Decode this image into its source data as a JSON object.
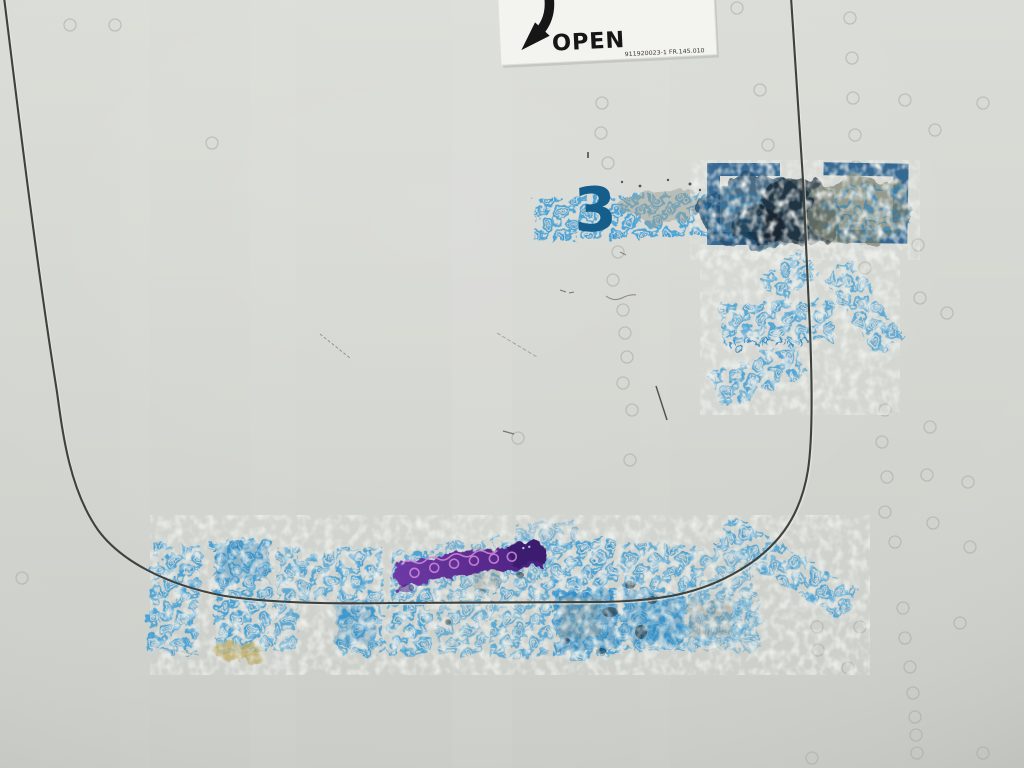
{
  "placard": {
    "label": "OPEN",
    "part_number": "911920023-1   FR.145.010",
    "arrow_icon": "arrow-down-left"
  },
  "panel": {
    "stencil_number": "3"
  },
  "stamps": {
    "micro_text": "101"
  },
  "colors": {
    "background_top": "#dadcd7",
    "background_bottom": "#cbcec8",
    "seam": "#3f413c",
    "seam_highlight": "#eceee9",
    "stencil_blue": "#155d8b",
    "bracket_blue": "#2e638f",
    "stamp_blue": "#3f9fd6",
    "stamp_blue_light": "#7cc4e8",
    "stamp_blue_dark": "#1f7fc0",
    "grime_navy": "#24506f",
    "grime_black": "#14242f",
    "grime_gray": "#77806f",
    "ribbon_purple": "#5c2d92",
    "ribbon_purple_dark": "#3a1b6e",
    "ribbon_pink": "#d58ad8",
    "stain_yellow": "#c2ae67",
    "placard_white": "#f3f3f0",
    "ink_black": "#161616"
  }
}
